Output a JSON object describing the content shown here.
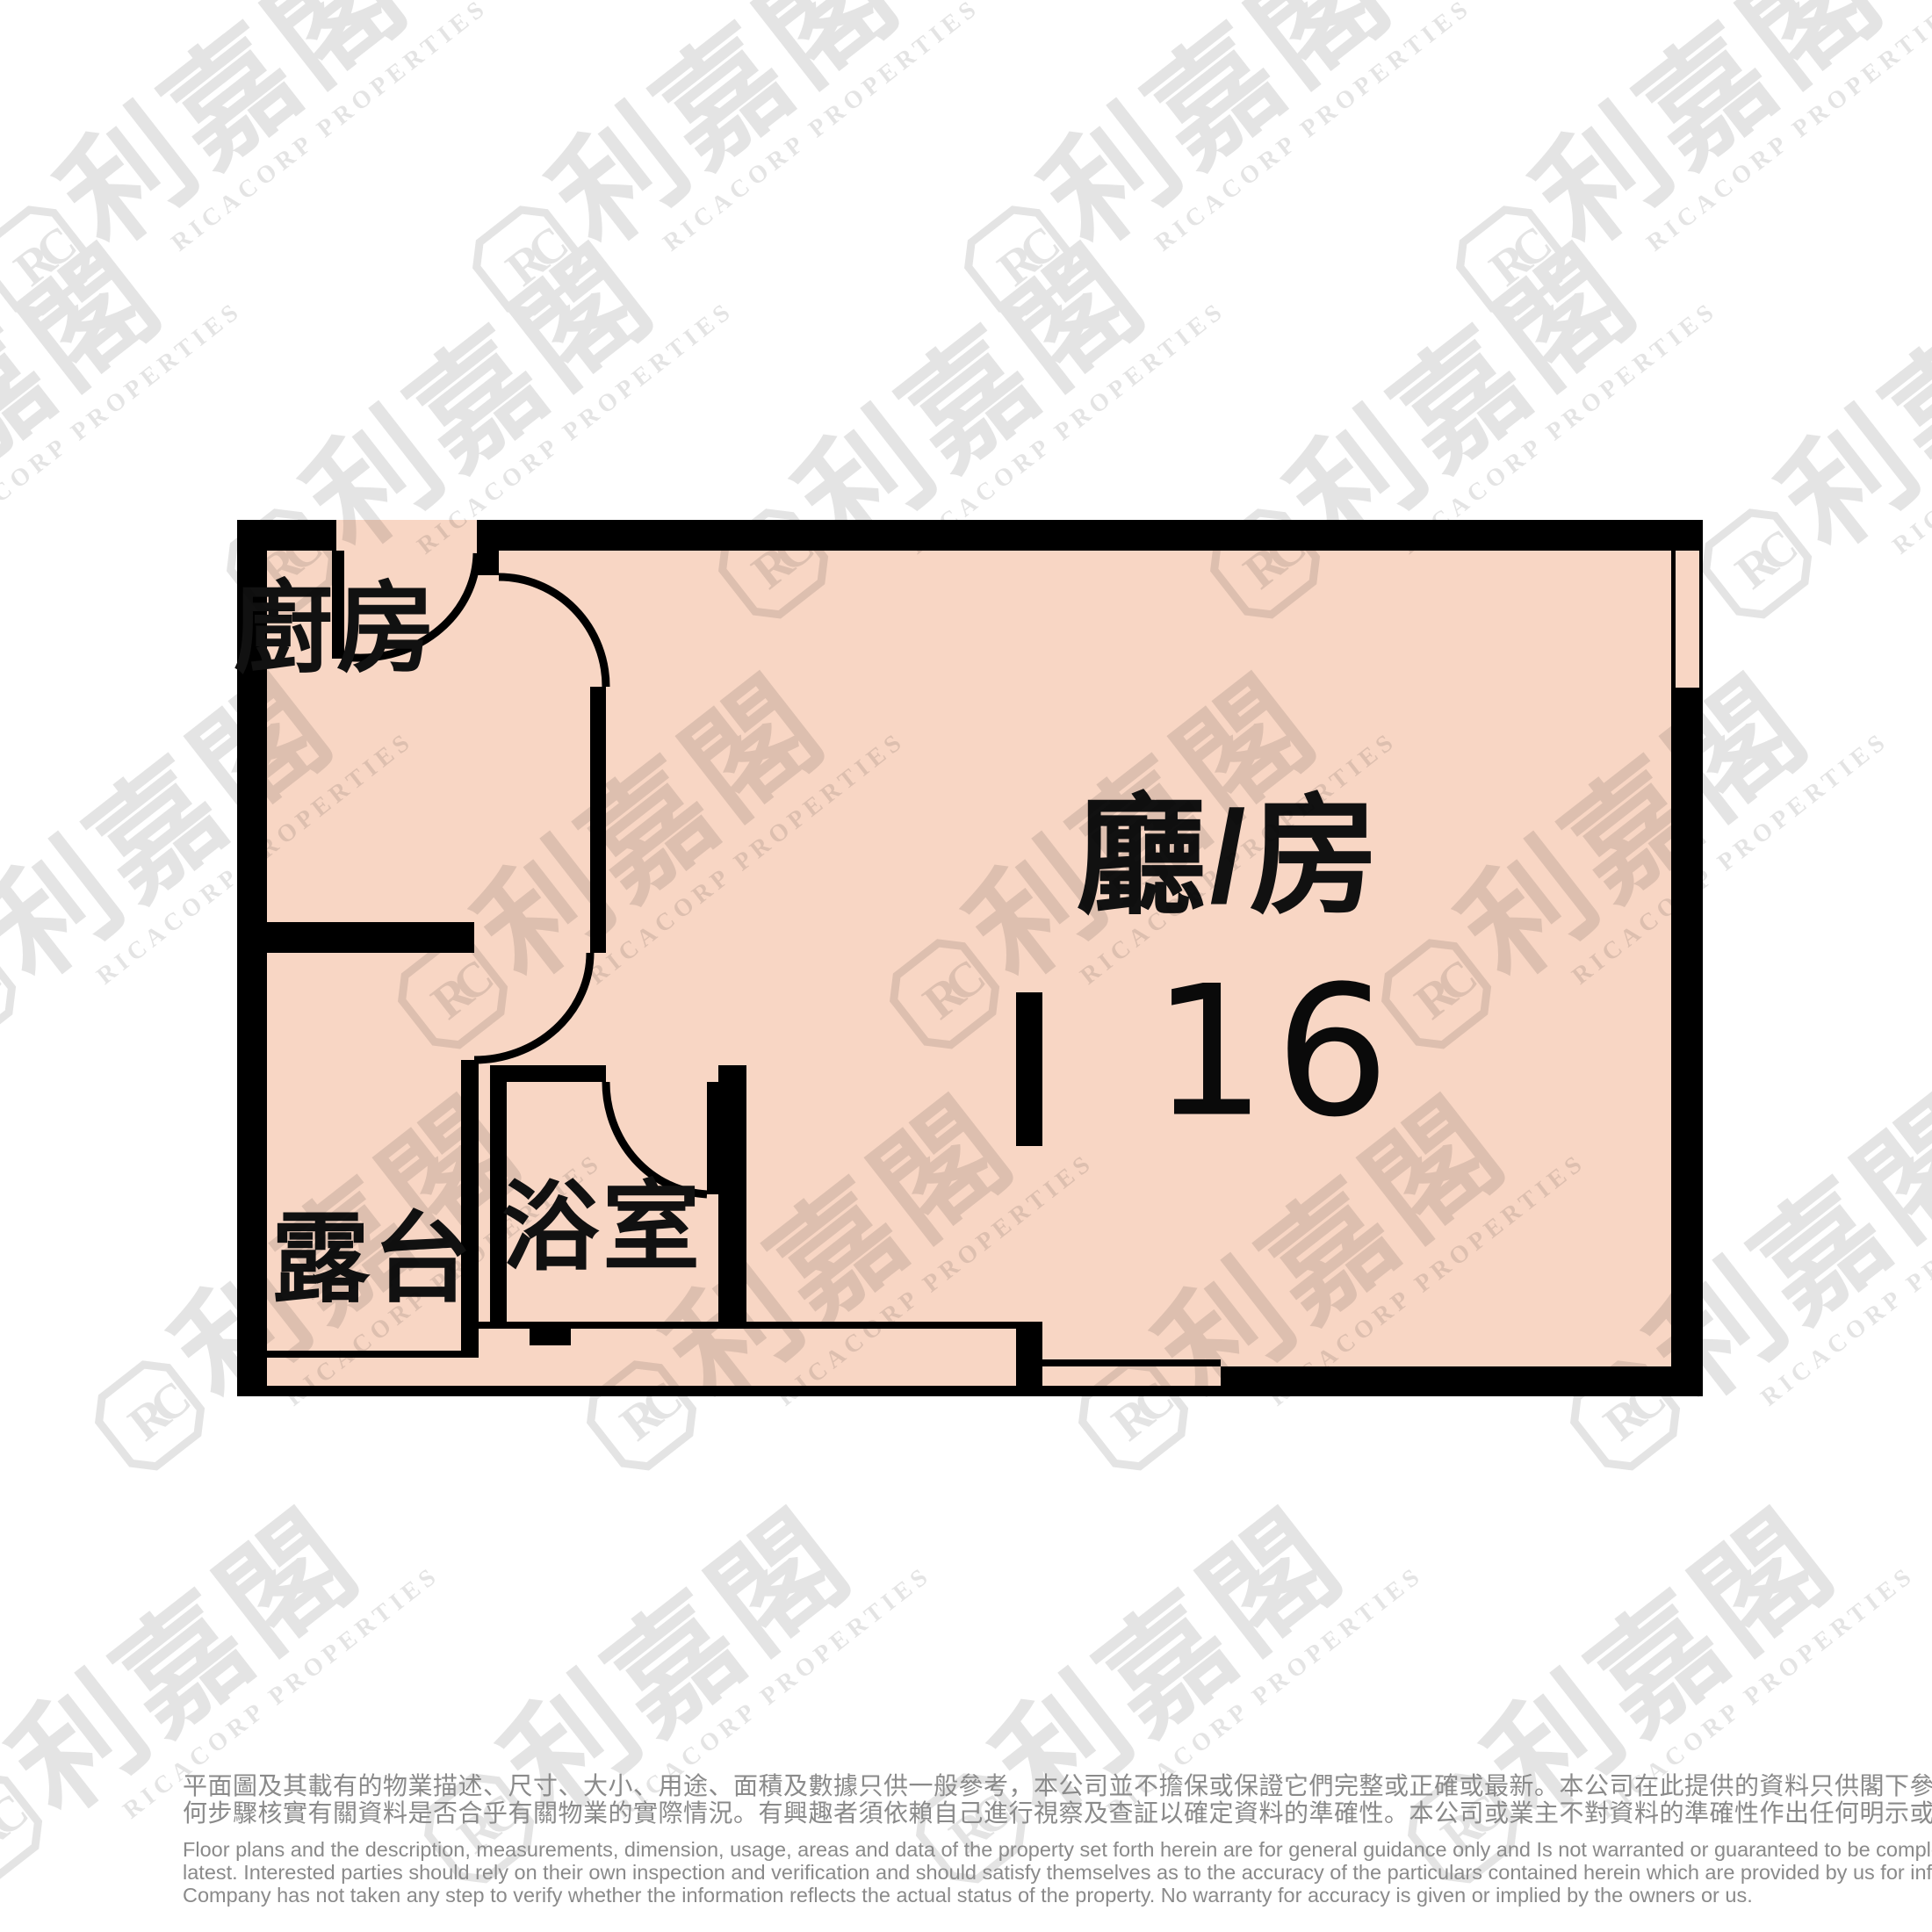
{
  "floor_plan": {
    "unit_number": "16",
    "rooms": [
      {
        "id": "kitchen",
        "label": "廚房"
      },
      {
        "id": "living_room",
        "label": "廳/房"
      },
      {
        "id": "balcony",
        "label": "露台"
      },
      {
        "id": "bathroom",
        "label": "浴室"
      }
    ],
    "colors": {
      "room_fill": "#f8d6c4",
      "wall": "#000000",
      "note_text": "#8a8a8a"
    }
  },
  "watermark": {
    "brand_cjk": "利嘉閣",
    "brand_en": "RICACORP PROPERTIES",
    "badge_initials": "RC"
  },
  "disclaimer": {
    "chinese_lines": [
      "平面圖及其載有的物業描述、尺寸、大小、用途、面積及數據只供一般參考，本公司並不擔保或保證它們完整或正確或最新。本公司在此提供的資料只供閣下參考，本公司並無採取任",
      "何步驟核實有關資料是否合乎有關物業的實際情況。有興趣者須依賴自己進行視察及查証以確定資料的準確性。本公司或業主不對資料的準確性作出任何明示或隱含的保證。"
    ],
    "english_lines": [
      "Floor plans and the description, measurements, dimension, usage, areas and data of the property set forth herein are for general guidance only and Is not warranted or guaranteed to be complete or correct or the",
      "latest. Interested parties should rely on their own inspection and verification and should satisfy themselves as to the accuracy of the particulars contained herein which are provided by us for information only.  Our",
      "Company has not taken any step to verify whether the information reflects the actual status of the property.  No warranty for accuracy is given or implied by the owners or us."
    ]
  }
}
